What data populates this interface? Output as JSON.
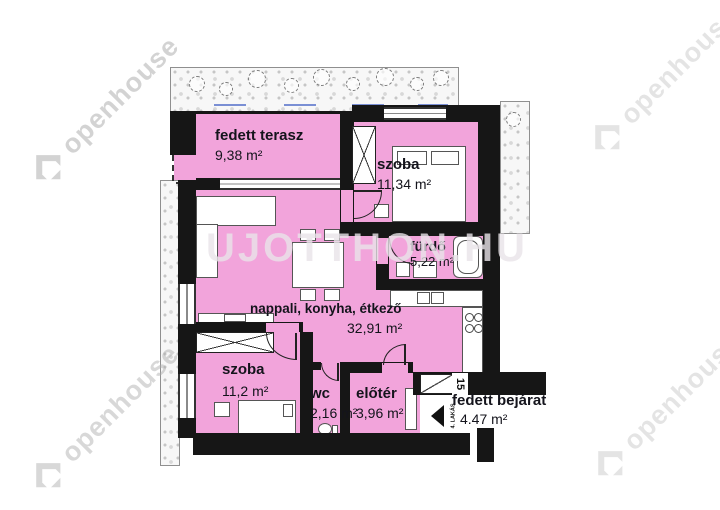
{
  "watermark": {
    "corner_text": "openhouse",
    "center_text": "UJOTTHON.HU"
  },
  "rooms": [
    {
      "key": "terrace",
      "label": "fedett terasz",
      "area": "9,38 m²"
    },
    {
      "key": "bedroom-upper",
      "label": "szoba",
      "area": "11,34 m²"
    },
    {
      "key": "bathroom",
      "label": "fürdő",
      "area": "5,22 m²"
    },
    {
      "key": "living-kitchen-dining",
      "label": "nappali, konyha, étkező",
      "area": "32,91 m²"
    },
    {
      "key": "bedroom-lower",
      "label": "szoba",
      "area": "11,2 m²"
    },
    {
      "key": "wc",
      "label": "wc",
      "area": "2,16 m²"
    },
    {
      "key": "hall",
      "label": "előtér",
      "area": "3,96 m²"
    },
    {
      "key": "covered-entrance",
      "label": "fedett bejárat",
      "area": "4.47 m²"
    }
  ],
  "annotations": {
    "door_width_label": "15",
    "apartment_direction_label": "4. LAKÁS"
  },
  "colors": {
    "room_fill": "#F2A4DB",
    "wall": "#161616",
    "watermark_gray": "#A9A9A9",
    "garden_dash_blue": "#7A8FD4",
    "label_text": "#14141C"
  }
}
